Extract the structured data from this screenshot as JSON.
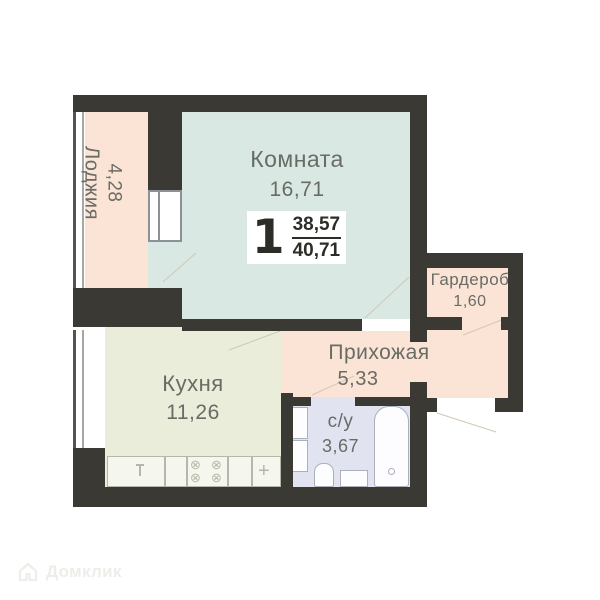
{
  "rooms": {
    "loggia": {
      "name": "Лоджия",
      "area": "4,28"
    },
    "living": {
      "name": "Комната",
      "area": "16,71"
    },
    "kitchen": {
      "name": "Кухня",
      "area": "11,26"
    },
    "hallway": {
      "name": "Прихожая",
      "area": "5,33"
    },
    "wardrobe": {
      "name": "Гардероб",
      "area": "1,60"
    },
    "bathroom": {
      "name": "с/у",
      "area": "3,67"
    }
  },
  "badge": {
    "rooms_count": "1",
    "area_living": "38,57",
    "area_total": "40,71"
  },
  "watermark": {
    "text": "Домклик"
  },
  "icons": {
    "stove_burner": "⊗",
    "counter_cross": "+"
  },
  "colors": {
    "wall": "#3b3934",
    "loggia_fill": "#fbe4d6",
    "living_fill": "#d9e8e3",
    "kitchen_fill": "#e9edda",
    "hallway_fill": "#fbe4d6",
    "wardrobe_fill": "#fbe4d6",
    "bathroom_fill": "#e2e3f0",
    "label_text": "#686c64",
    "badge_text": "#2d2d28"
  }
}
